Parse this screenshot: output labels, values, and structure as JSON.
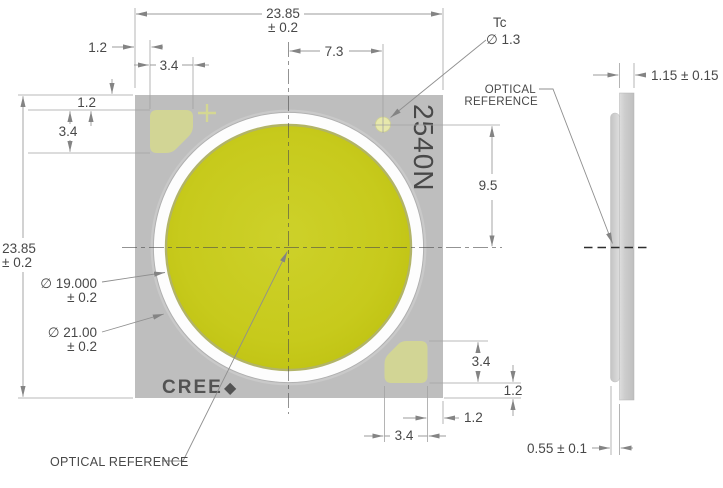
{
  "front_view": {
    "marking": "2540N",
    "logo_text": "CREE",
    "logo_mark": "◆",
    "thermal_pad": {
      "label": "Tc",
      "diameter": "∅ 1.3"
    },
    "optical_reference_label": "OPTICAL REFERENCE",
    "dimensions": {
      "overall_width": {
        "value": "23.85",
        "tolerance": "± 0.2"
      },
      "overall_height": {
        "value": "23.85",
        "tolerance": "± 0.2"
      },
      "les_diameter": {
        "value": "∅ 19.000",
        "tolerance": "± 0.2"
      },
      "outer_ring_diameter": {
        "value": "∅ 21.00",
        "tolerance": "± 0.2"
      },
      "tc_offset_x": "7.3",
      "tc_offset_y": "9.5",
      "pad_margin_top": "1.2",
      "pad_size_top": "3.4",
      "pad_margin_left": "1.2",
      "pad_size_left": "3.4",
      "pad_size_bottom_right_v": "3.4",
      "pad_margin_bottom_right_v": "1.2",
      "pad_margin_bottom_right_h": "1.2",
      "pad_size_bottom_right_h": "3.4"
    }
  },
  "side_view": {
    "overall_thickness": "1.15 ± 0.15",
    "lens_height": "0.55 ± 0.1",
    "optical_reference_line1": "OPTICAL",
    "optical_reference_line2": "REFERENCE"
  },
  "colors": {
    "substrate": "#bebebe",
    "les_yellow": "#c6c91c",
    "pad_pale": "#d6d98e",
    "dim_line": "#9b9b9b",
    "text": "#484848"
  }
}
